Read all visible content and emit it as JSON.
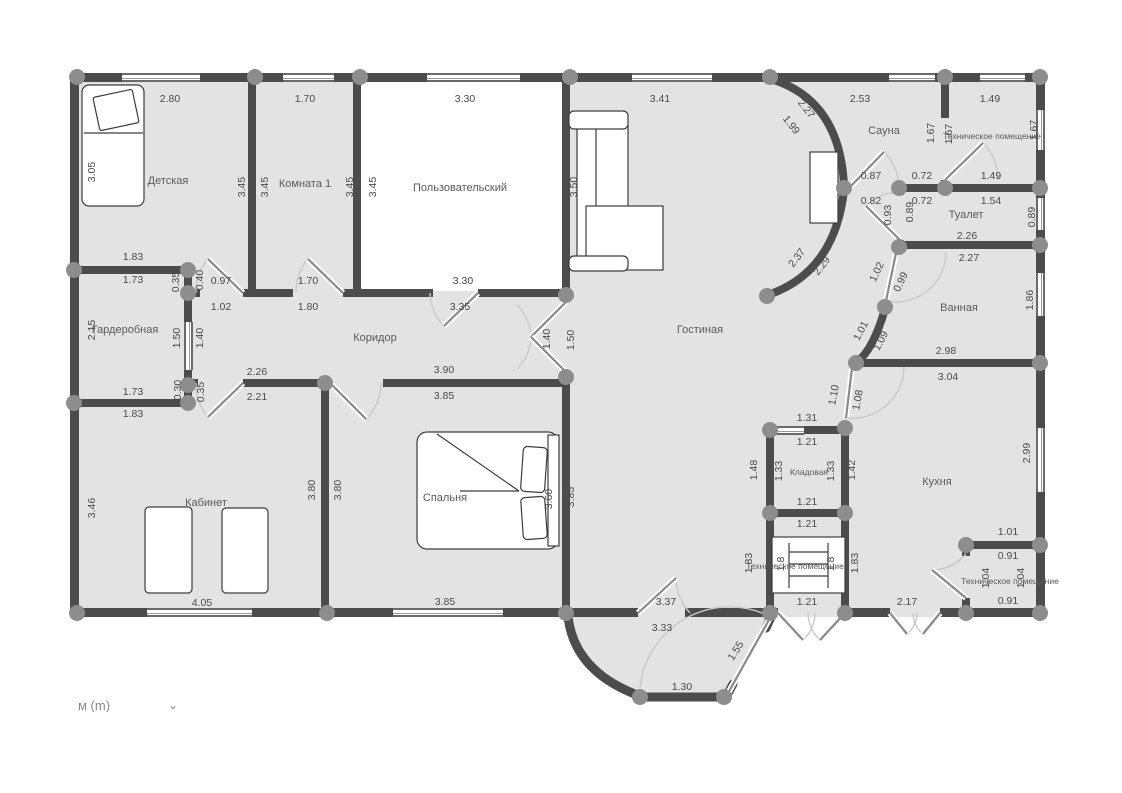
{
  "app": {
    "type": "floor-plan-editor"
  },
  "units": {
    "label": "м (m)",
    "chevron": "⌄"
  },
  "colors": {
    "wall": "#4c4c4c",
    "floor": "#e3e3e3",
    "node": "#8d8d8d",
    "text": "#4a4a4a",
    "swing": "#cccccc"
  },
  "room_labels": [
    {
      "t": "Детская",
      "x": 168,
      "y": 181
    },
    {
      "t": "Комната 1",
      "x": 305,
      "y": 184
    },
    {
      "t": "Пользовательский",
      "x": 460,
      "y": 188
    },
    {
      "t": "Гостиная",
      "x": 700,
      "y": 330
    },
    {
      "t": "Сауна",
      "x": 884,
      "y": 131
    },
    {
      "t": "Техническое помещение",
      "x": 992,
      "y": 136,
      "s": "sm"
    },
    {
      "t": "Туалет",
      "x": 966,
      "y": 215
    },
    {
      "t": "Ванная",
      "x": 959,
      "y": 308
    },
    {
      "t": "Гардеробная",
      "x": 125,
      "y": 330
    },
    {
      "t": "Коридор",
      "x": 375,
      "y": 338
    },
    {
      "t": "Кабинет",
      "x": 206,
      "y": 503
    },
    {
      "t": "Спальня",
      "x": 445,
      "y": 498
    },
    {
      "t": "Кладовая",
      "x": 809,
      "y": 472,
      "s": "sm"
    },
    {
      "t": "Техническое помещение",
      "x": 795,
      "y": 566,
      "s": "sm"
    },
    {
      "t": "Кухня",
      "x": 937,
      "y": 482
    },
    {
      "t": "Техническое помещение",
      "x": 1010,
      "y": 581,
      "s": "sm"
    }
  ],
  "dim_labels": [
    {
      "t": "2.80",
      "x": 170,
      "y": 99
    },
    {
      "t": "1.70",
      "x": 305,
      "y": 99
    },
    {
      "t": "3.30",
      "x": 465,
      "y": 99
    },
    {
      "t": "3.41",
      "x": 660,
      "y": 99
    },
    {
      "t": "2.53",
      "x": 860,
      "y": 99
    },
    {
      "t": "1.49",
      "x": 990,
      "y": 99
    },
    {
      "t": "0.87",
      "x": 871,
      "y": 176
    },
    {
      "t": "0.72",
      "x": 922,
      "y": 176
    },
    {
      "t": "1.49",
      "x": 991,
      "y": 176
    },
    {
      "t": "0.82",
      "x": 871,
      "y": 201
    },
    {
      "t": "0.72",
      "x": 922,
      "y": 201
    },
    {
      "t": "1.54",
      "x": 991,
      "y": 201
    },
    {
      "t": "2.26",
      "x": 967,
      "y": 236
    },
    {
      "t": "2.27",
      "x": 969,
      "y": 258
    },
    {
      "t": "2.98",
      "x": 946,
      "y": 351
    },
    {
      "t": "3.04",
      "x": 948,
      "y": 377
    },
    {
      "t": "1.31",
      "x": 807,
      "y": 418
    },
    {
      "t": "1.21",
      "x": 807,
      "y": 442
    },
    {
      "t": "1.21",
      "x": 807,
      "y": 502
    },
    {
      "t": "1.21",
      "x": 807,
      "y": 524
    },
    {
      "t": "1.21",
      "x": 807,
      "y": 602
    },
    {
      "t": "2.17",
      "x": 907,
      "y": 602
    },
    {
      "t": "1.01",
      "x": 1008,
      "y": 532
    },
    {
      "t": "0.91",
      "x": 1008,
      "y": 556
    },
    {
      "t": "0.91",
      "x": 1008,
      "y": 601
    },
    {
      "t": "3.37",
      "x": 666,
      "y": 602
    },
    {
      "t": "3.33",
      "x": 662,
      "y": 628
    },
    {
      "t": "1.30",
      "x": 682,
      "y": 687
    },
    {
      "t": "3.85",
      "x": 445,
      "y": 602
    },
    {
      "t": "4.05",
      "x": 202,
      "y": 603
    },
    {
      "t": "1.83",
      "x": 133,
      "y": 257
    },
    {
      "t": "1.73",
      "x": 133,
      "y": 280
    },
    {
      "t": "1.73",
      "x": 133,
      "y": 392
    },
    {
      "t": "1.83",
      "x": 133,
      "y": 414
    },
    {
      "t": "0.97",
      "x": 221,
      "y": 281
    },
    {
      "t": "1.02",
      "x": 221,
      "y": 307
    },
    {
      "t": "1.70",
      "x": 308,
      "y": 281
    },
    {
      "t": "1.80",
      "x": 308,
      "y": 307
    },
    {
      "t": "2.26",
      "x": 257,
      "y": 372
    },
    {
      "t": "2.21",
      "x": 257,
      "y": 397
    },
    {
      "t": "3.90",
      "x": 444,
      "y": 370
    },
    {
      "t": "3.85",
      "x": 444,
      "y": 396
    },
    {
      "t": "3.30",
      "x": 463,
      "y": 281
    },
    {
      "t": "3.35",
      "x": 460,
      "y": 307
    },
    {
      "t": "3.05",
      "x": 92,
      "y": 172,
      "r": -90
    },
    {
      "t": "3.45",
      "x": 242,
      "y": 187,
      "r": -90
    },
    {
      "t": "3.45",
      "x": 265,
      "y": 187,
      "r": -90
    },
    {
      "t": "3.45",
      "x": 350,
      "y": 187,
      "r": -90
    },
    {
      "t": "3.45",
      "x": 373,
      "y": 187,
      "r": -90
    },
    {
      "t": "3.50",
      "x": 574,
      "y": 187,
      "r": -90
    },
    {
      "t": "2.15",
      "x": 92,
      "y": 330,
      "r": -90
    },
    {
      "t": "1.50",
      "x": 177,
      "y": 338,
      "r": -90
    },
    {
      "t": "1.40",
      "x": 200,
      "y": 338,
      "r": -90
    },
    {
      "t": "0.35",
      "x": 176,
      "y": 282,
      "r": -90
    },
    {
      "t": "0.40",
      "x": 200,
      "y": 280,
      "r": -90
    },
    {
      "t": "0.30",
      "x": 178,
      "y": 390,
      "r": -90
    },
    {
      "t": "0.35",
      "x": 201,
      "y": 392,
      "r": -90
    },
    {
      "t": "1.40",
      "x": 547,
      "y": 339,
      "r": -90
    },
    {
      "t": "1.50",
      "x": 571,
      "y": 340,
      "r": -90
    },
    {
      "t": "3.46",
      "x": 92,
      "y": 508,
      "r": -90
    },
    {
      "t": "3.80",
      "x": 312,
      "y": 490,
      "r": -90
    },
    {
      "t": "3.80",
      "x": 338,
      "y": 490,
      "r": -90
    },
    {
      "t": "3.60",
      "x": 549,
      "y": 499,
      "r": -90
    },
    {
      "t": "3.85",
      "x": 571,
      "y": 497,
      "r": -90
    },
    {
      "t": "1.67",
      "x": 931,
      "y": 133,
      "r": -90
    },
    {
      "t": "1.67",
      "x": 949,
      "y": 134,
      "r": -90
    },
    {
      "t": "1.67",
      "x": 1034,
      "y": 130,
      "r": -90
    },
    {
      "t": "0.89",
      "x": 1032,
      "y": 217,
      "r": -90
    },
    {
      "t": "0.93",
      "x": 888,
      "y": 215,
      "r": -90
    },
    {
      "t": "0.89",
      "x": 910,
      "y": 212,
      "r": -90
    },
    {
      "t": "1.86",
      "x": 1030,
      "y": 300,
      "r": -90
    },
    {
      "t": "2.99",
      "x": 1027,
      "y": 453,
      "r": -90
    },
    {
      "t": "1.48",
      "x": 754,
      "y": 470,
      "r": -90
    },
    {
      "t": "1.33",
      "x": 779,
      "y": 471,
      "r": -90
    },
    {
      "t": "1.33",
      "x": 831,
      "y": 471,
      "r": -90
    },
    {
      "t": "1.42",
      "x": 852,
      "y": 470,
      "r": -90
    },
    {
      "t": "1.83",
      "x": 749,
      "y": 563,
      "r": -90
    },
    {
      "t": "1.8",
      "x": 781,
      "y": 564,
      "r": -90
    },
    {
      "t": "1.8",
      "x": 831,
      "y": 564,
      "r": -90
    },
    {
      "t": "1.83",
      "x": 855,
      "y": 563,
      "r": -90
    },
    {
      "t": "1.04",
      "x": 986,
      "y": 578,
      "r": -90
    },
    {
      "t": "1.04",
      "x": 1021,
      "y": 578,
      "r": -90
    },
    {
      "t": "2.27",
      "x": 806,
      "y": 109,
      "r": 52
    },
    {
      "t": "1.99",
      "x": 791,
      "y": 125,
      "r": 52
    },
    {
      "t": "2.37",
      "x": 797,
      "y": 258,
      "r": -52
    },
    {
      "t": "2.29",
      "x": 822,
      "y": 266,
      "r": -52
    },
    {
      "t": "1.02",
      "x": 877,
      "y": 272,
      "r": -65
    },
    {
      "t": "0.99",
      "x": 901,
      "y": 282,
      "r": -65
    },
    {
      "t": "1.01",
      "x": 861,
      "y": 331,
      "r": -62
    },
    {
      "t": "1.09",
      "x": 881,
      "y": 341,
      "r": -62
    },
    {
      "t": "1.10",
      "x": 834,
      "y": 395,
      "r": -80
    },
    {
      "t": "1.08",
      "x": 858,
      "y": 400,
      "r": -80
    },
    {
      "t": "2.23",
      "x": 590,
      "y": 665,
      "r": 42
    },
    {
      "t": "1.55",
      "x": 736,
      "y": 651,
      "r": -58
    }
  ]
}
